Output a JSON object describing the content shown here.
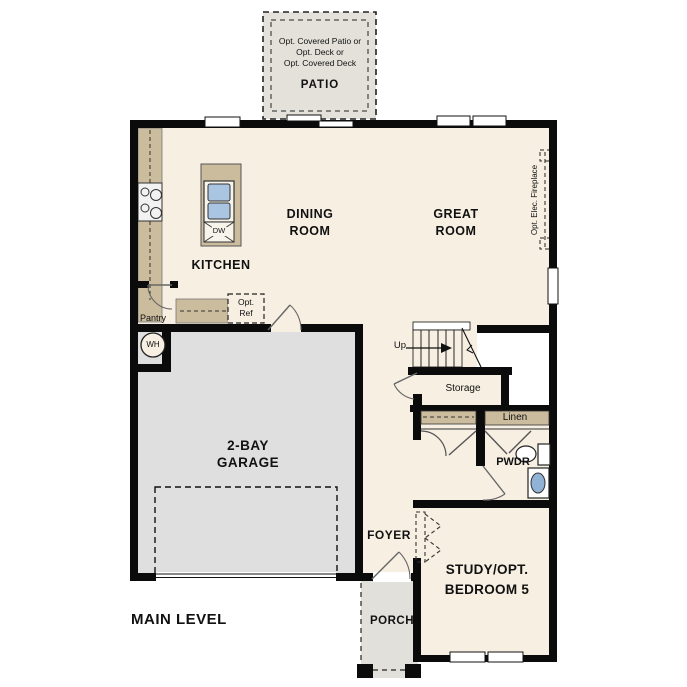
{
  "title": "MAIN LEVEL",
  "colors": {
    "floor_cream": "#f6efe2",
    "counter_tan": "#cbbc9e",
    "garage_gray": "#dfdfdf",
    "patio_gray": "#e3e1da",
    "porch_gray": "#e2e0da",
    "sink_blue": "#a9c5e2",
    "basin_blue": "#8fb2d5",
    "wall_black": "#0b0b0b"
  },
  "patio": {
    "notes": [
      "Opt. Covered Patio or",
      "Opt. Deck or",
      "Opt. Covered Deck"
    ],
    "label": "PATIO"
  },
  "rooms": {
    "dining": {
      "line1": "DINING",
      "line2": "ROOM"
    },
    "great": {
      "line1": "GREAT",
      "line2": "ROOM"
    },
    "kitchen": {
      "label": "KITCHEN"
    },
    "garage": {
      "line1": "2-BAY",
      "line2": "GARAGE"
    },
    "study": {
      "line1": "STUDY/OPT.",
      "line2": "BEDROOM 5"
    },
    "foyer": {
      "label": "FOYER"
    },
    "porch": {
      "label": "PORCH"
    },
    "pwdr": {
      "label": "PWDR"
    }
  },
  "features": {
    "pantry": "Pantry",
    "optref_line1": "Opt.",
    "optref_line2": "Ref",
    "wh": "WH",
    "dw": "DW",
    "up": "Up",
    "storage": "Storage",
    "linen": "Linen",
    "fireplace": "Opt. Elec. Fireplace"
  }
}
